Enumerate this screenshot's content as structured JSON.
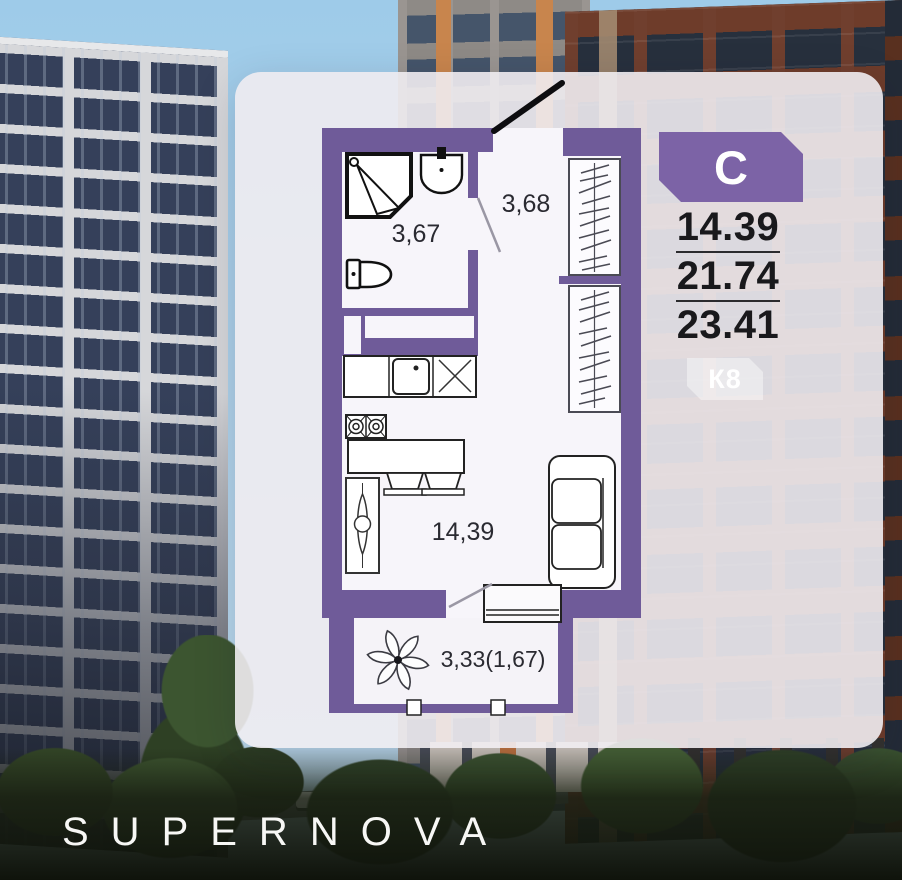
{
  "brand": {
    "logo_text": "SUPERNOVA"
  },
  "panel": {
    "apartment_type_badge": "С",
    "area_living": "14.39",
    "area_apartment": "21.74",
    "area_total": "23.41",
    "building_badge": "К8"
  },
  "floorplan": {
    "labels": {
      "bathroom": "3,67",
      "hallway": "3,68",
      "living_kitchen": "14,39",
      "balcony": "3,33(1,67)"
    }
  },
  "colors": {
    "wall_purple": "#6f5b99",
    "badge_purple": "#7c63a6",
    "numbers_text": "#19191c",
    "logo_text_color": "#f7f7f5"
  }
}
